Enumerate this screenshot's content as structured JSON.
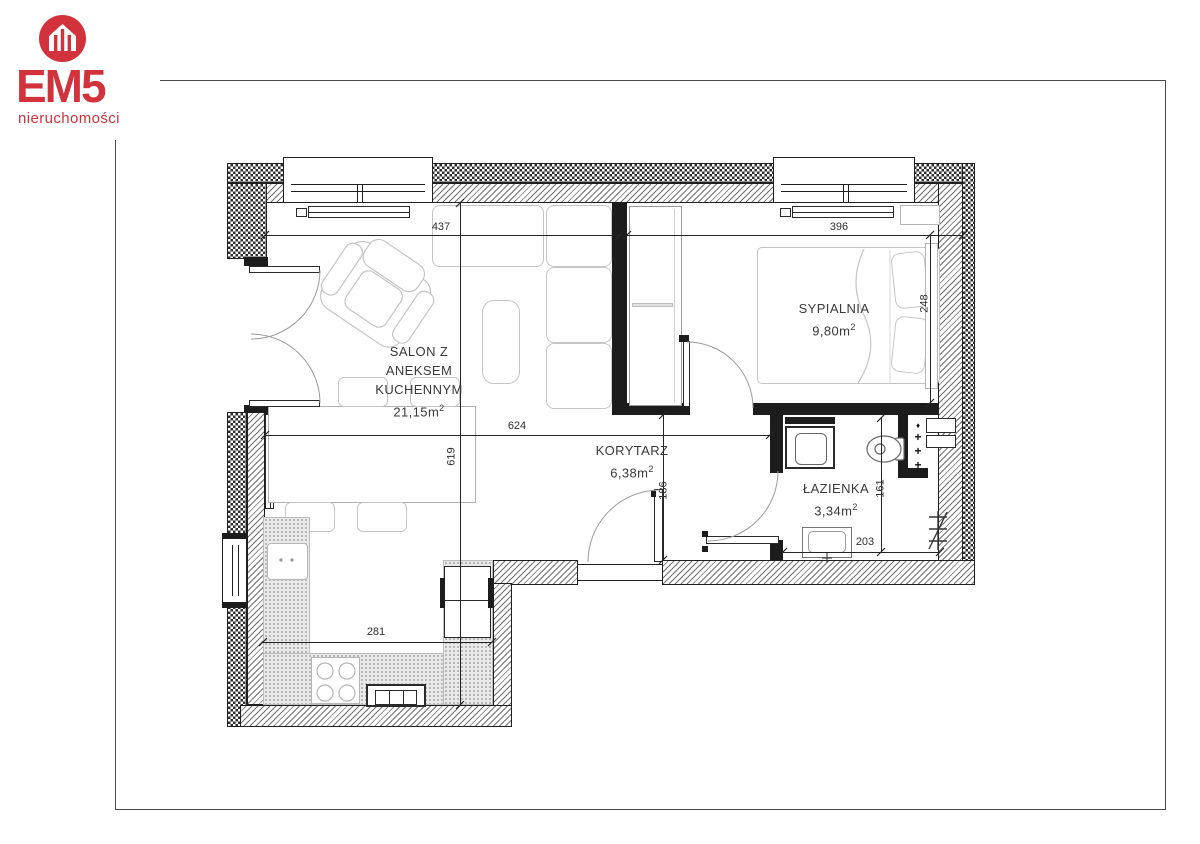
{
  "logo": {
    "brand": "EM5",
    "subtitle": "nieruchomości",
    "accent_color": "#d2323b",
    "icon": "house-icon"
  },
  "rooms": {
    "salon": {
      "line1": "SALON Z",
      "line2": "ANEKSEM",
      "line3": "KUCHENNYM",
      "area": "21,15m",
      "area_sup": "2"
    },
    "sypialnia": {
      "name": "SYPIALNIA",
      "area": "9,80m",
      "area_sup": "2"
    },
    "korytarz": {
      "name": "KORYTARZ",
      "area": "6,38m",
      "area_sup": "2"
    },
    "lazienka": {
      "name": "ŁAZIENKA",
      "area": "3,34m",
      "area_sup": "2"
    }
  },
  "dimensions": {
    "salon_width": "437",
    "bedroom_width": "396",
    "bedroom_depth": "248",
    "open_width": "624",
    "left_depth": "619",
    "corridor_depth": "186",
    "bathroom_depth": "161",
    "bathroom_width": "203",
    "kitchen_width": "281"
  },
  "bathroom": {
    "shaft_plus": "+",
    "shaft_diamond": "♦"
  }
}
